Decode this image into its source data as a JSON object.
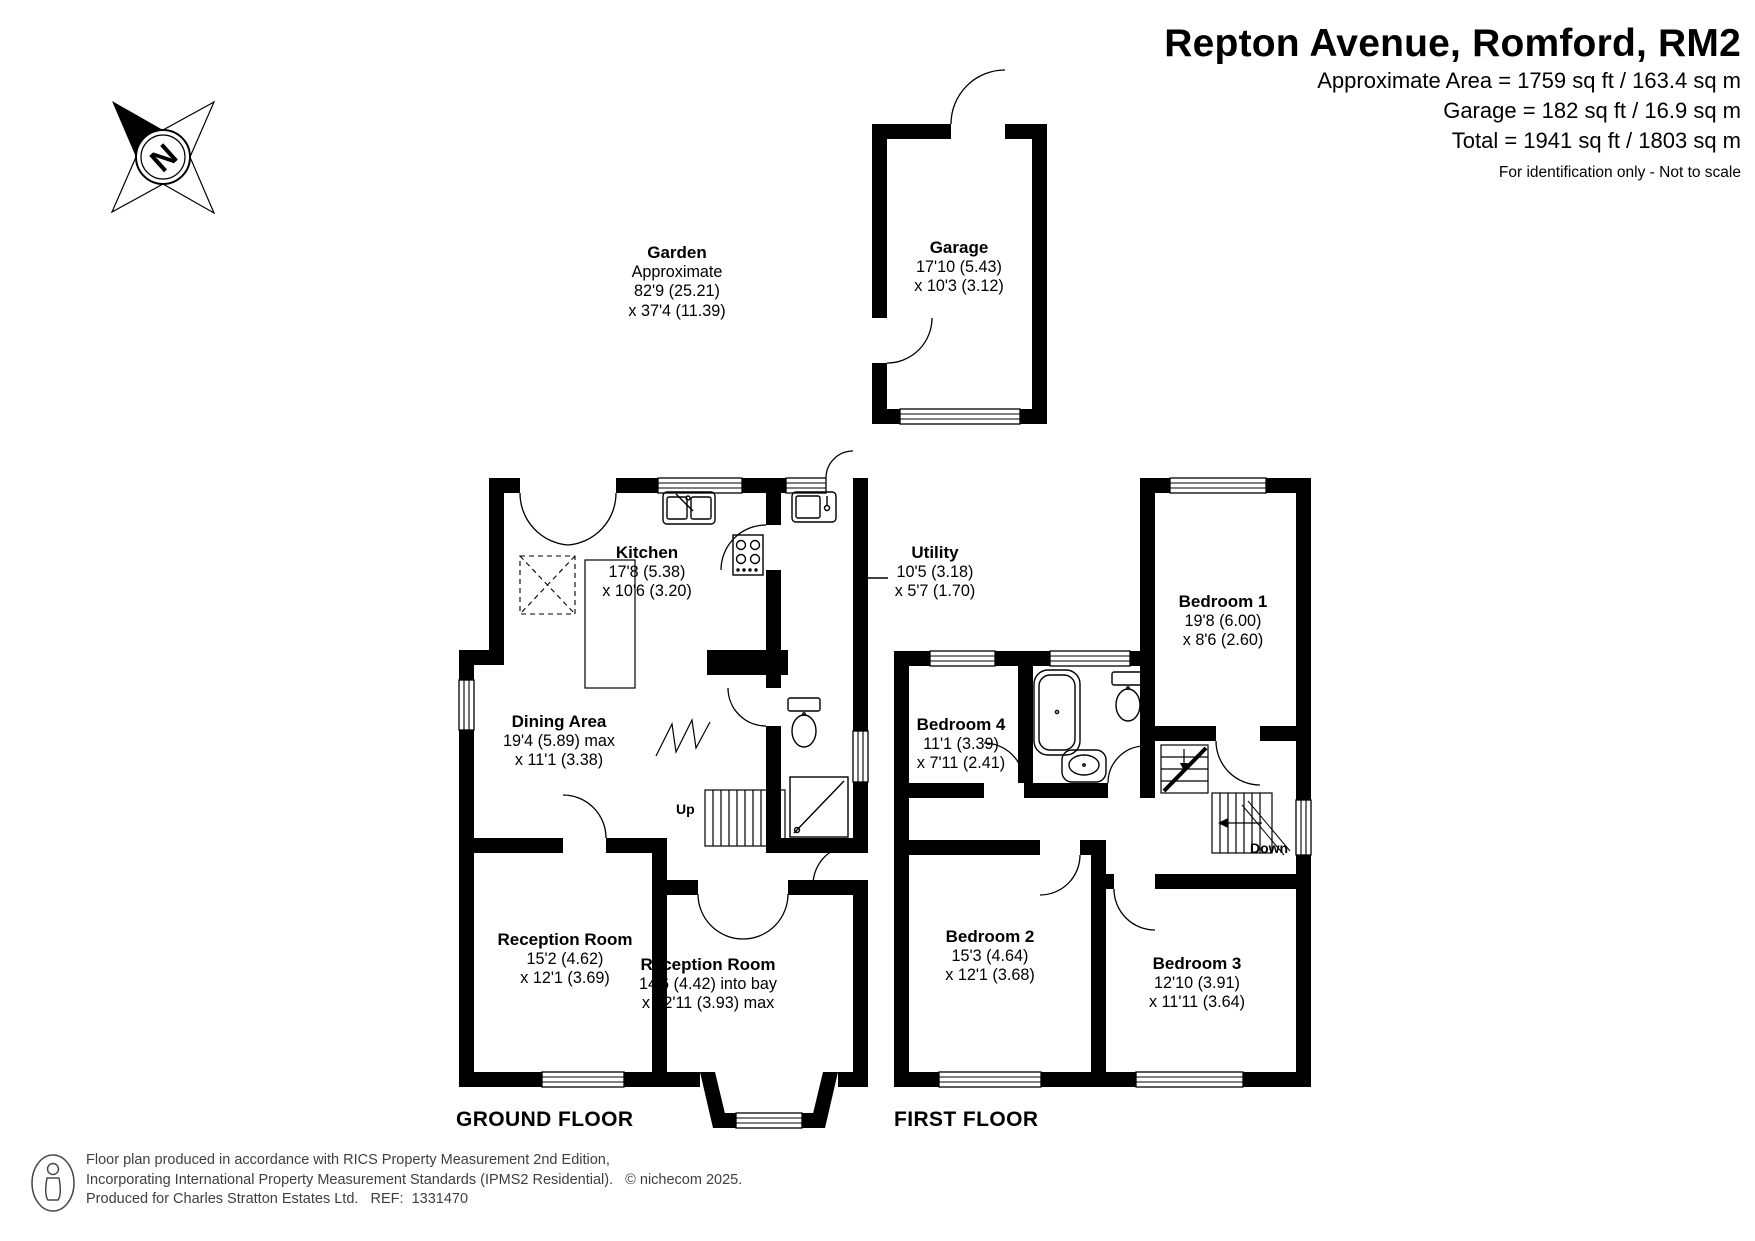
{
  "header": {
    "title": "Repton Avenue, Romford, RM2",
    "area": "Approximate Area = 1759 sq ft / 163.4 sq m",
    "garage": "Garage = 182 sq ft / 16.9 sq m",
    "total": "Total = 1941 sq ft / 1803 sq m",
    "disclaimer": "For identification only - Not to scale"
  },
  "compass": {
    "label": "N"
  },
  "garden": {
    "name": "Garden",
    "note": "Approximate",
    "dim1": "82'9 (25.21)",
    "dim2": "x 37'4 (11.39)"
  },
  "rooms": {
    "garage": {
      "name": "Garage",
      "dim1": "17'10 (5.43)",
      "dim2": "x 10'3 (3.12)"
    },
    "kitchen": {
      "name": "Kitchen",
      "dim1": "17'8 (5.38)",
      "dim2": "x 10'6 (3.20)"
    },
    "utility": {
      "name": "Utility",
      "dim1": "10'5 (3.18)",
      "dim2": "x 5'7 (1.70)"
    },
    "dining": {
      "name": "Dining Area",
      "dim1": "19'4 (5.89) max",
      "dim2": "x 11'1 (3.38)"
    },
    "reception1": {
      "name": "Reception Room",
      "dim1": "15'2 (4.62)",
      "dim2": "x 12'1 (3.69)"
    },
    "reception2": {
      "name": "Reception Room",
      "dim1": "14'6 (4.42) into bay",
      "dim2": "x 12'11 (3.93) max"
    },
    "bedroom1": {
      "name": "Bedroom 1",
      "dim1": "19'8 (6.00)",
      "dim2": "x 8'6 (2.60)"
    },
    "bedroom2": {
      "name": "Bedroom 2",
      "dim1": "15'3 (4.64)",
      "dim2": "x 12'1 (3.68)"
    },
    "bedroom3": {
      "name": "Bedroom 3",
      "dim1": "12'10 (3.91)",
      "dim2": "x 11'11 (3.64)"
    },
    "bedroom4": {
      "name": "Bedroom 4",
      "dim1": "11'1 (3.39)",
      "dim2": "x 7'11 (2.41)"
    }
  },
  "stairs": {
    "up": "Up",
    "down": "Down"
  },
  "floor_labels": {
    "ground": "GROUND FLOOR",
    "first": "FIRST FLOOR"
  },
  "footer": {
    "line1": "Floor plan produced in accordance with RICS Property Measurement 2nd Edition,",
    "line2": "Incorporating International Property Measurement Standards (IPMS2 Residential).   © nichecom 2025.",
    "line3": "Produced for Charles Stratton Estates Ltd.   REF:  1331470"
  },
  "colors": {
    "wall": "#000000",
    "footer_text": "#3f3f3f"
  }
}
